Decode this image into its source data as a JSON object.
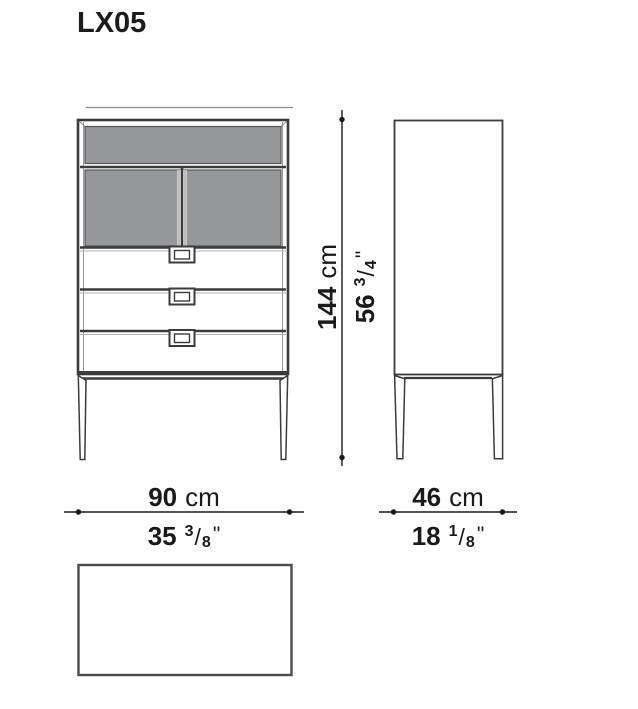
{
  "title": "LX05",
  "dimensions": {
    "height": {
      "cm_value": "144",
      "cm_unit": "cm",
      "in_value": "56",
      "frac_numerator": "3",
      "frac_slash": "/",
      "frac_denominator": "4",
      "inch_mark": "\""
    },
    "front_width": {
      "cm_value": "90",
      "cm_unit": "cm",
      "in_value": "35",
      "frac_numerator": "3",
      "frac_slash": "/",
      "frac_denominator": "8",
      "inch_mark": "\""
    },
    "depth": {
      "cm_value": "46",
      "cm_unit": "cm",
      "in_value": "18",
      "frac_numerator": "1",
      "frac_slash": "/",
      "frac_denominator": "8",
      "inch_mark": "\""
    }
  },
  "colors": {
    "panel_gray": "#96979a",
    "outline_dark": "#3b3b3b",
    "dim_line": "#1a1a1a"
  }
}
